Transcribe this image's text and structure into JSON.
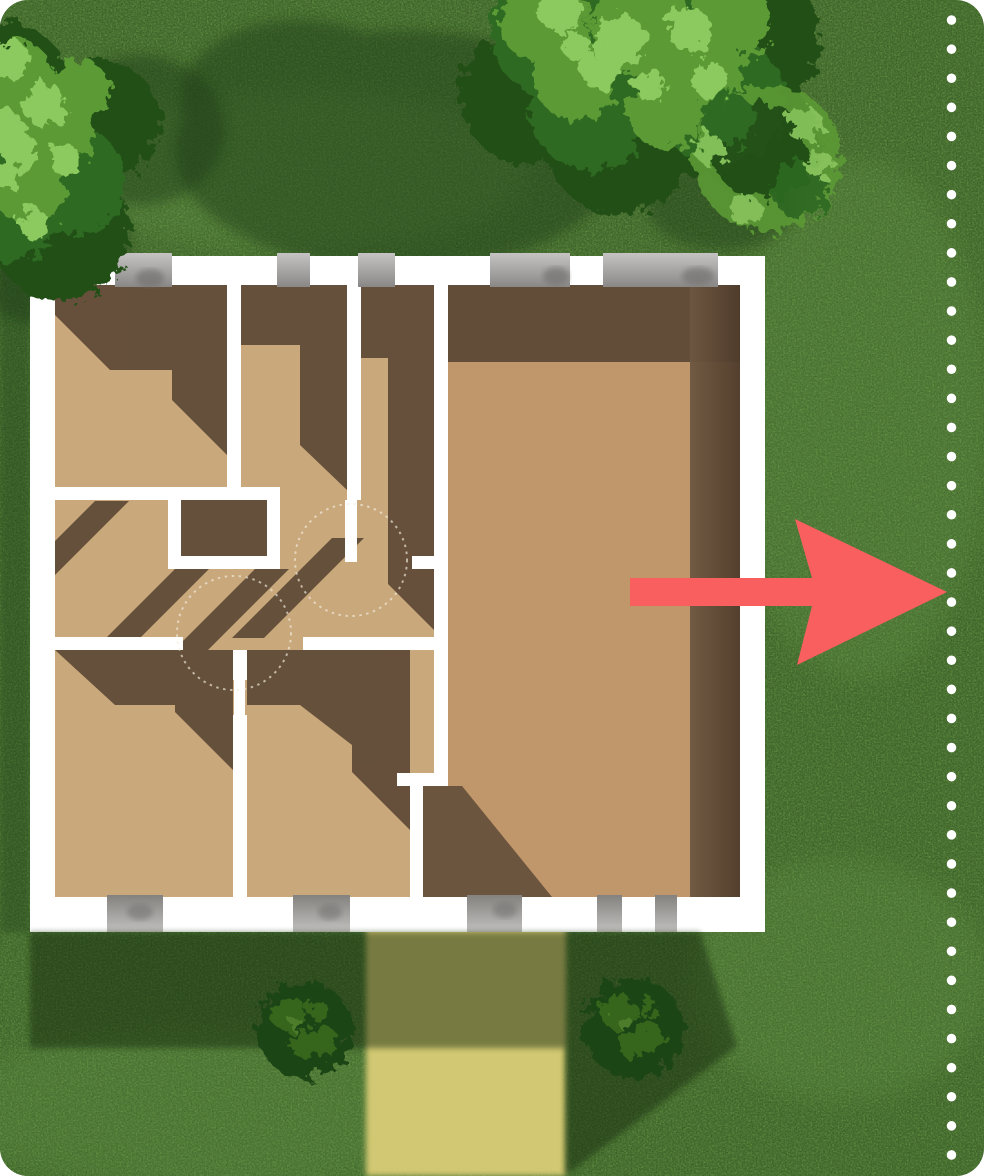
{
  "scene": {
    "type": "aerial-lawn-floorplan-illustration",
    "card_background": "#ffffff",
    "lawn": {
      "grass_base": "#55813a",
      "grass_speckle": "#16300d",
      "grass_light_patch": "#7cae58",
      "house_shadow": "#14290c",
      "tree_shadow": "#1d3a12",
      "left_edge_shadow": "#1d3a12"
    },
    "path": {
      "color": "#d2c772"
    },
    "trees": {
      "foliage_dark": "#224f19",
      "foliage_mid": "#2f6a21",
      "foliage_light": "#5c9a36",
      "foliage_highlight": "#8cc95e",
      "bush_dark": "#1e4517",
      "bush_mid": "#35661f"
    },
    "house": {
      "wall_color": "#ffffff",
      "window_gray_light": "#c4c2c0",
      "window_gray_dark": "#848280",
      "floor_left_color": "#c9a87c",
      "floor_big_room_color": "#c0976b",
      "floor_shadow_color": "#5d4936",
      "door_arc_color": "#f3ecdf"
    },
    "arrow": {
      "color": "#f95f5f",
      "direction": "right"
    },
    "boundary_dotted_line": {
      "color": "#ffffff",
      "orientation": "vertical"
    }
  }
}
